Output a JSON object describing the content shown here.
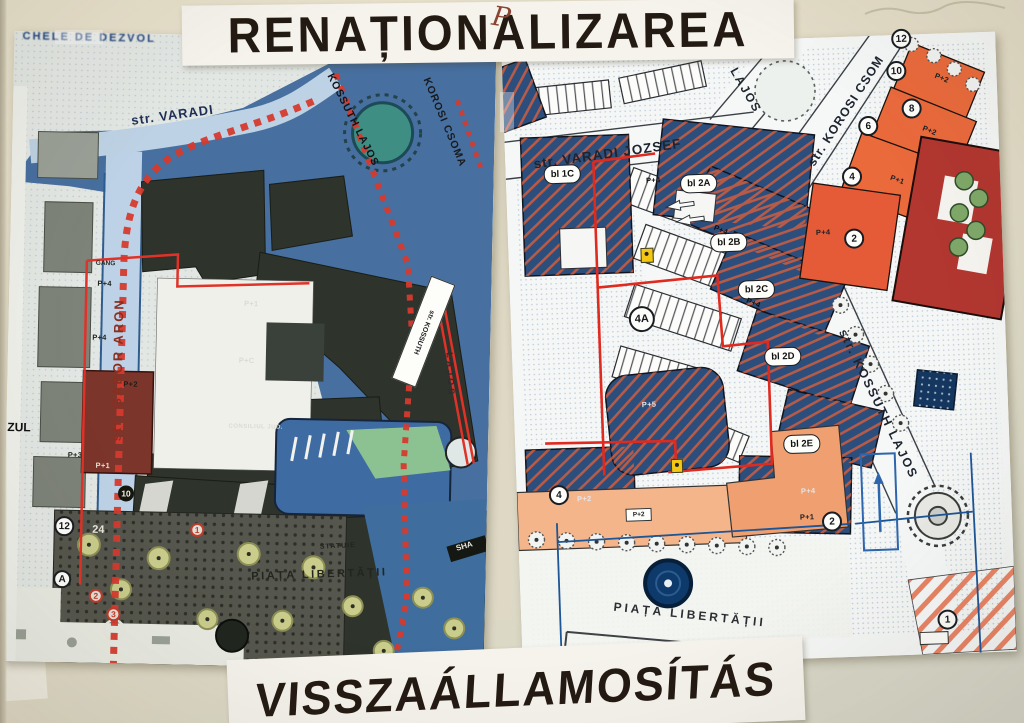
{
  "photo": {
    "wall_color": "#e4decb",
    "handwritten_mark": "P"
  },
  "headlines": {
    "top": "RENAȚIONALIZAREA",
    "bottom": "VISSZAÁLLAMOSÍTÁS"
  },
  "left_map": {
    "title_fragment": "CHELE DE DEZVOL",
    "streets": {
      "varadi": "str. VARADI",
      "gabor_aron": "str. GABOR ARON",
      "korosi": "KOROSI CSOMA",
      "kossuth": "KOSSUTH LAJOS",
      "kossuth_box": "str. KOSSUTH",
      "lajos": "LAJOS"
    },
    "labels": {
      "zul": "ZUL",
      "gang": "GANG",
      "consiliul": "CONSILIUL JUD.",
      "statuie": "STATUIE",
      "piata": "PIAȚA LIBERTĂȚII",
      "sha": "SHA",
      "num24": "24"
    },
    "circles": [
      "12",
      "A",
      "10",
      "1",
      "2",
      "3"
    ],
    "floors": [
      "P+4",
      "P+4",
      "P+1",
      "P+C",
      "P+2",
      "P+3",
      "P+1"
    ]
  },
  "right_map": {
    "streets": {
      "varadi": "str. VARADI JOZSEF",
      "lajos": "LAJOS",
      "korosi": "str. KOROSI CSOM",
      "kossuth": "str. KOSSUTH LAJOS"
    },
    "blocks": [
      "bl 1C",
      "bl 2A",
      "bl 2B",
      "bl 2C",
      "bl 2D",
      "bl 2E"
    ],
    "circles": [
      "12",
      "10",
      "8",
      "6",
      "4",
      "2",
      "4A",
      "4",
      "2",
      "1"
    ],
    "floors": [
      "P+2",
      "P+2",
      "P+1",
      "P+4",
      "P+4",
      "P+4",
      "P+4",
      "P+5",
      "P+2",
      "P+2",
      "P+1",
      "P+4"
    ],
    "labels": {
      "piata": "PIAȚA LIBERTĂȚII",
      "tour_info": "Tour info"
    }
  },
  "colors": {
    "wall": "#e4decb",
    "headline_paper": "#f5f3ec",
    "headline_text": "#231a13",
    "map_blue": "#476f9f",
    "block_navy": "#2b4e7c",
    "hatch_red": "#d95f3b",
    "orange": "#ea6a3c",
    "light_orange": "#f5b58b",
    "dark_red_building": "#b23730",
    "left_dark_building": "#2e332c",
    "left_red_building": "#7c352b",
    "teal": "#3e8e84",
    "tree_yellow": "#c9cc8b",
    "tree_green": "#7fa869",
    "red_line": "#df2a20",
    "navy_line": "#1d5596"
  }
}
